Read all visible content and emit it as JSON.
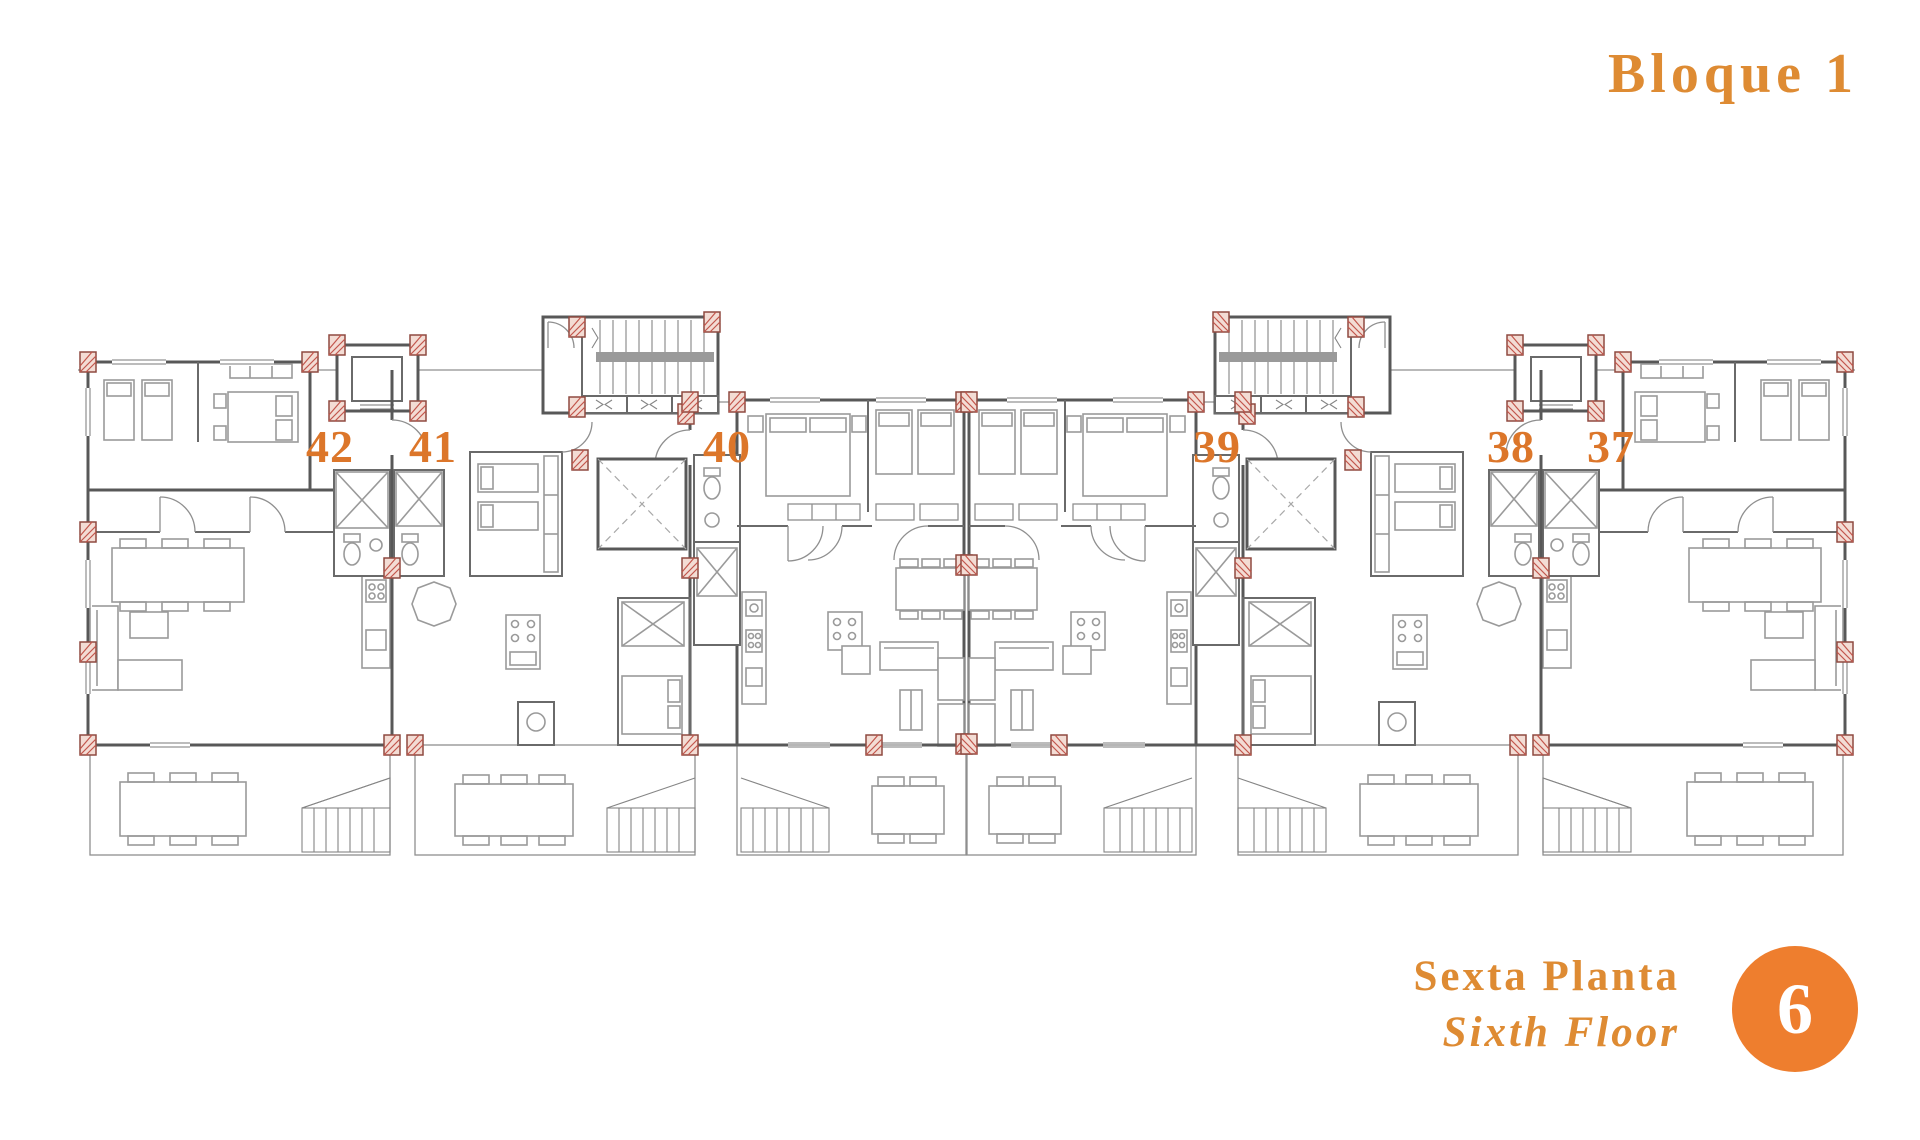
{
  "header": {
    "title": "Bloque 1",
    "accent_color": "#DE8B33"
  },
  "plan": {
    "units": [
      {
        "number": "42"
      },
      {
        "number": "41"
      },
      {
        "number": "40"
      },
      {
        "number": "39"
      },
      {
        "number": "38"
      },
      {
        "number": "37"
      }
    ],
    "unit_label_color": "#DC762A",
    "line_color": "#6a6a6a",
    "column_marker_color": "#C2564C",
    "features": {
      "stair_cores": 2,
      "elevator_cores": 2,
      "terraces": 6
    }
  },
  "footer": {
    "floor_label_es": "Sexta Planta",
    "floor_label_en": "Sixth Floor",
    "floor_number": "6",
    "badge_color": "#EE7E2E"
  }
}
